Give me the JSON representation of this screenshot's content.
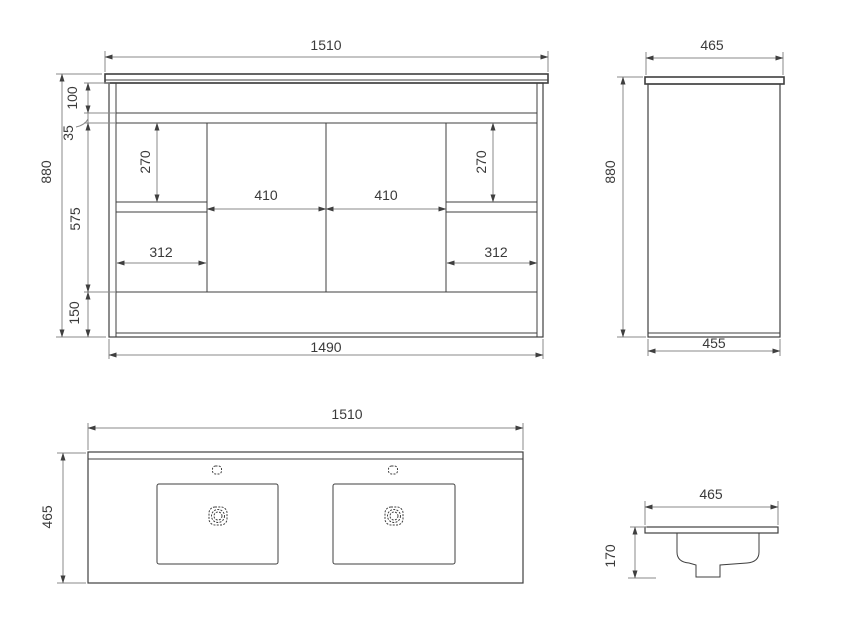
{
  "colors": {
    "object_line": "#3f3f3f",
    "dim_line": "#8a8a8a",
    "text": "#3a3a3a",
    "background": "#ffffff"
  },
  "views": {
    "cabinet_front": {
      "dims": {
        "countertop_width": "1510",
        "overall_height": "880",
        "top_rail": "100",
        "rail_gap": "35",
        "upper_drawer_height_left": "270",
        "upper_drawer_height_right": "270",
        "door_width_left": "410",
        "door_width_right": "410",
        "door_section_height": "575",
        "drawer_width_left": "312",
        "drawer_width_right": "312",
        "kick_height": "150",
        "carcass_width": "1490"
      }
    },
    "cabinet_side": {
      "dims": {
        "countertop_depth": "465",
        "overall_height": "880",
        "carcass_depth": "455"
      }
    },
    "basin_top": {
      "dims": {
        "width": "1510",
        "depth": "465"
      }
    },
    "basin_section": {
      "dims": {
        "depth": "465",
        "bowl_height": "170"
      }
    }
  }
}
